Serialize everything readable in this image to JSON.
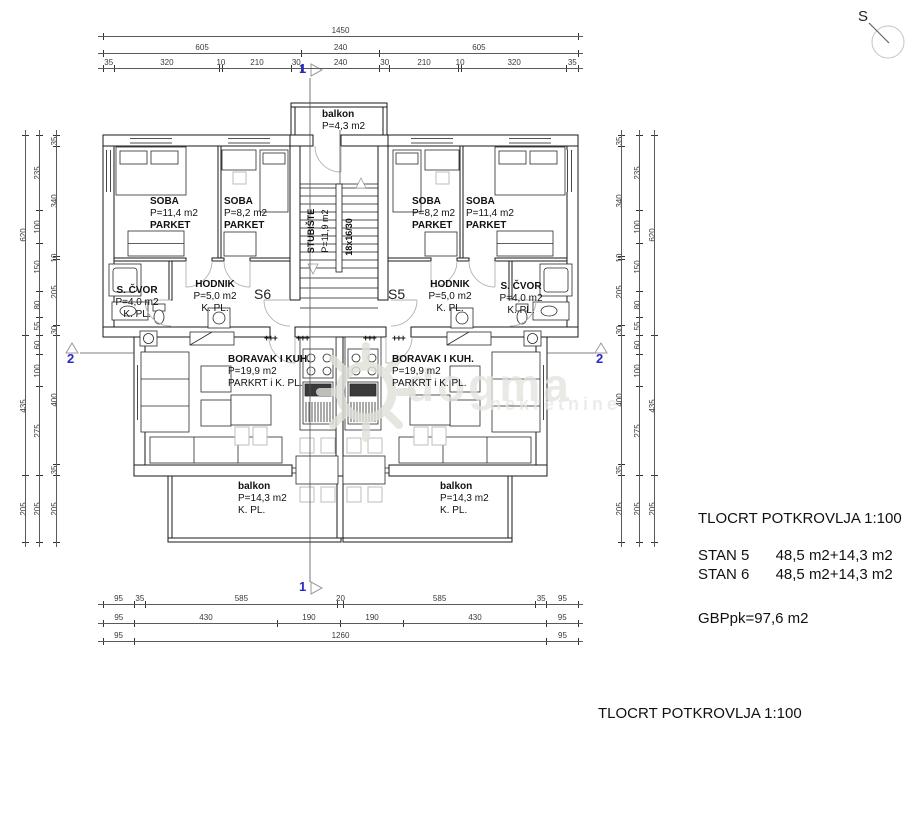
{
  "colors": {
    "line": "#1a1a1a",
    "marker_blue": "#2a2ac4",
    "door_gray": "#b2b2b2",
    "watermark": "#e2e2dd"
  },
  "north": {
    "label": "S"
  },
  "units": {
    "s5": "S5",
    "s6": "S6"
  },
  "radiator_symbol": "+++",
  "rooms": {
    "balkon_top": {
      "name": "balkon",
      "area": "P=4,3 m2"
    },
    "s6": {
      "soba1": {
        "name": "SOBA",
        "area": "P=11,4 m2",
        "floor": "PARKET"
      },
      "soba2": {
        "name": "SOBA",
        "area": "P=8,2 m2",
        "floor": "PARKET"
      },
      "scvor": {
        "name": "S. ČVOR",
        "area": "P=4,0 m2",
        "floor": "K. PL."
      },
      "hodnik": {
        "name": "HODNIK",
        "area": "P=5,0 m2",
        "floor": "K. PL."
      },
      "boravak": {
        "name": "BORAVAK I KUH.",
        "area": "P=19,9 m2",
        "floor": "PARKRT i K. PL."
      },
      "balkon": {
        "name": "balkon",
        "area": "P=14,3 m2",
        "floor": "K. PL."
      }
    },
    "s5": {
      "soba1": {
        "name": "SOBA",
        "area": "P=11,4 m2",
        "floor": "PARKET"
      },
      "soba2": {
        "name": "SOBA",
        "area": "P=8,2 m2",
        "floor": "PARKET"
      },
      "scvor": {
        "name": "S. ČVOR",
        "area": "P=4,0 m2",
        "floor": "K. PL."
      },
      "hodnik": {
        "name": "HODNIK",
        "area": "P=5,0 m2",
        "floor": "K. PL."
      },
      "boravak": {
        "name": "BORAVAK I KUH.",
        "area": "P=19,9 m2",
        "floor": "PARKRT i K. PL."
      },
      "balkon": {
        "name": "balkon",
        "area": "P=14,3 m2",
        "floor": "K. PL."
      }
    },
    "stubiste": {
      "name": "STUBIŠTE",
      "area": "P=11,9 m2",
      "steps": "18x16/30"
    }
  },
  "markers": {
    "section1": "1",
    "section2": "2"
  },
  "dims": {
    "top": {
      "row1": [
        "1450"
      ],
      "row2": [
        "605",
        "240",
        "605"
      ],
      "row3": [
        "35",
        "320",
        "10",
        "210",
        "30",
        "240",
        "30",
        "210",
        "10",
        "320",
        "35"
      ]
    },
    "bottom": {
      "row1": [
        "95",
        "35",
        "585",
        "20",
        "585",
        "35",
        "95"
      ],
      "row2": [
        "95",
        "430",
        "190",
        "190",
        "430",
        "95"
      ],
      "row3": [
        "95",
        "1260",
        "95"
      ]
    },
    "left": {
      "outer": [
        "620",
        "435",
        "205"
      ],
      "mid": [
        "235",
        "100",
        "150",
        "80",
        "55",
        "60",
        "100",
        "275",
        "205"
      ],
      "inner": [
        "35",
        "340",
        "10",
        "205",
        "30",
        "400",
        "35",
        "205"
      ]
    },
    "right": {
      "inner": [
        "35",
        "340",
        "10",
        "205",
        "30",
        "400",
        "35",
        "205"
      ],
      "mid": [
        "235",
        "100",
        "150",
        "80",
        "55",
        "60",
        "100",
        "275",
        "205"
      ],
      "outer": [
        "620",
        "435",
        "205"
      ]
    }
  },
  "legend": {
    "title": "TLOCRT POTKROVLJA 1:100",
    "stan5_label": "STAN 5",
    "stan5_value": "48,5 m2+14,3 m2",
    "stan6_label": "STAN 6",
    "stan6_value": "48,5 m2+14,3 m2",
    "gbp": "GBPpk=97,6 m2"
  },
  "footer_title": "TLOCRT POTKROVLJA  1:100",
  "watermark": {
    "brand": "dogma",
    "sub": "nekretnine"
  }
}
